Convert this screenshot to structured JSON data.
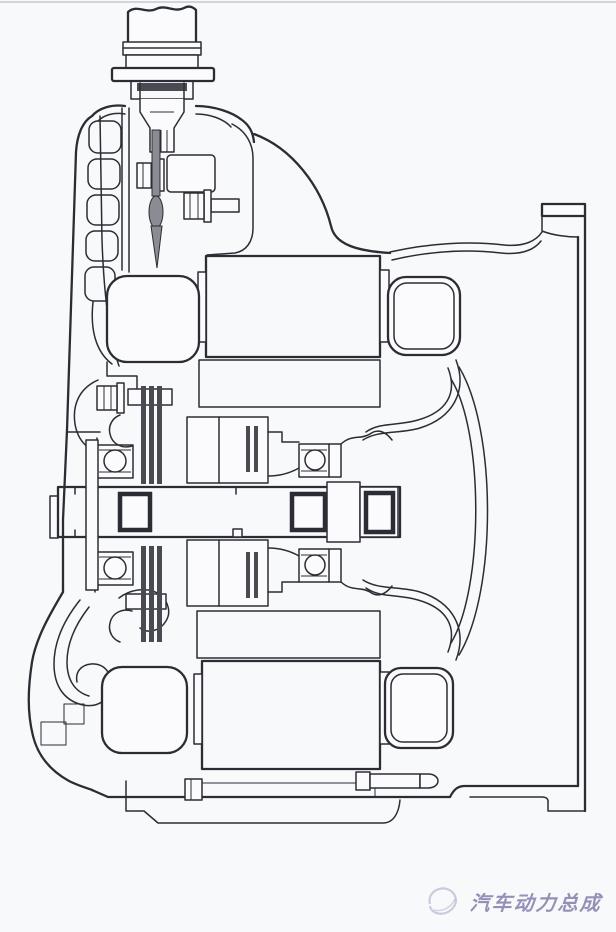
{
  "meta": {
    "description": "Engineering cross-section drawing of an automotive hybrid/electric drive unit: housing, two motor lamination stacks with end windings, central shaft with ball bearings, splines, bolts and oil passages"
  },
  "watermark": {
    "text": "汽车动力总成",
    "logo_icon": "swoosh-logo-icon"
  },
  "colors": {
    "bg": "#f8f9fa",
    "paper": "#fbfbfd",
    "line": "#2c2c35",
    "dark": "#4a4a53",
    "metal": "#8b8b93",
    "lam_fill": "#c6c6cb",
    "lam_line": "#5e5e66",
    "thread_bg": "#c9c9cd",
    "thread_tick": "#3f3f47",
    "xhatch": "#6a6a72",
    "wm": "#6e69a0",
    "border_top": "#c6c7cf"
  }
}
